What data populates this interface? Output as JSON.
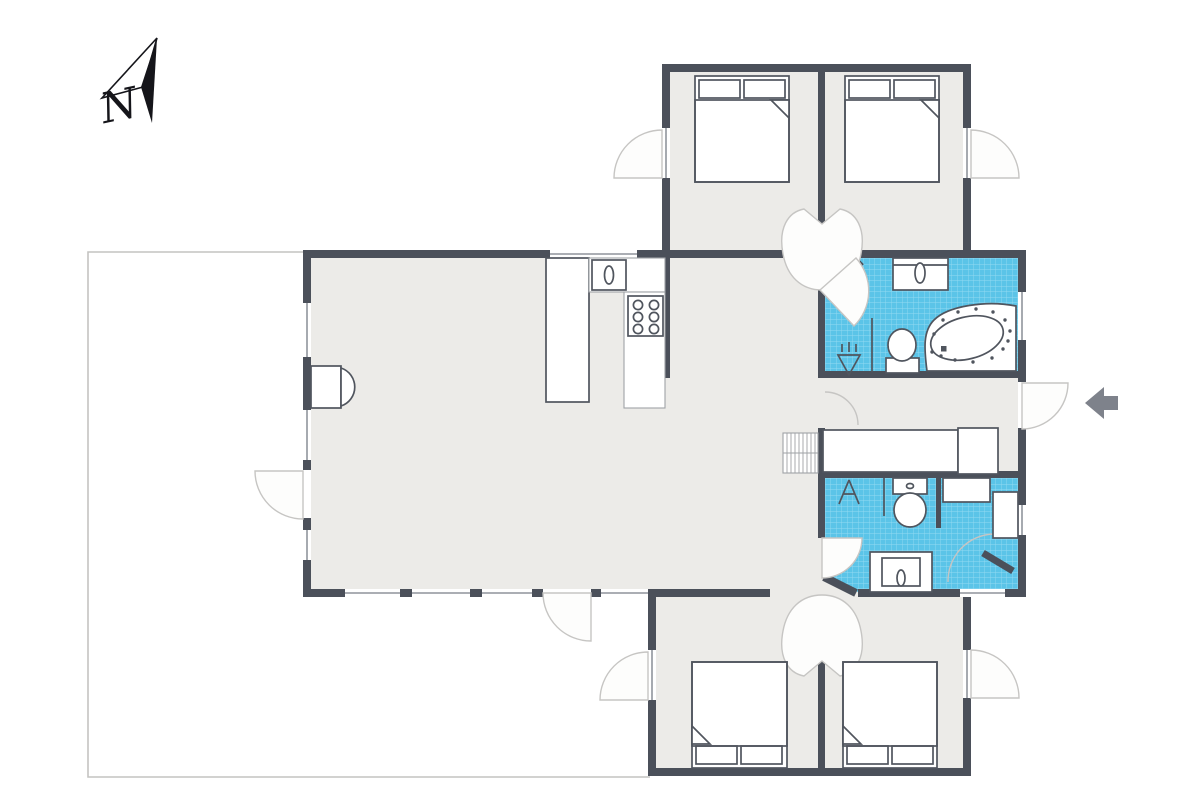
{
  "compass": {
    "label": "N"
  },
  "colors": {
    "wall": "#4b505a",
    "floor": "#ecebe8",
    "tile": "#5bc4e8",
    "tile_grid": "#93daf2",
    "fixture_line": "#50555e",
    "counter_line": "#9fa2a6",
    "window_line": "#8f949c",
    "swing_line": "#c6c5c3",
    "terrace_line": "#c4c3c1",
    "arrow": "#7e828b",
    "north": "#15151a"
  },
  "icons": {
    "north_arrow": "compass-north-pointer",
    "entrance_arrow": "left-pointing-entry-arrow",
    "bed": "double-bed-with-two-pillows",
    "stove": "cooktop-burners",
    "sink": "basin-with-oval",
    "toilet": "toilet-tank-and-bowl",
    "spa_tub": "oval-jet-tub",
    "shower": "shower-drain-symbol",
    "stairs": "hatched-steps",
    "fireplace": "wood-stove-half-round",
    "wardrobe": "closet-block",
    "door": "quarter-circle-swing",
    "window": "casement-arc"
  }
}
